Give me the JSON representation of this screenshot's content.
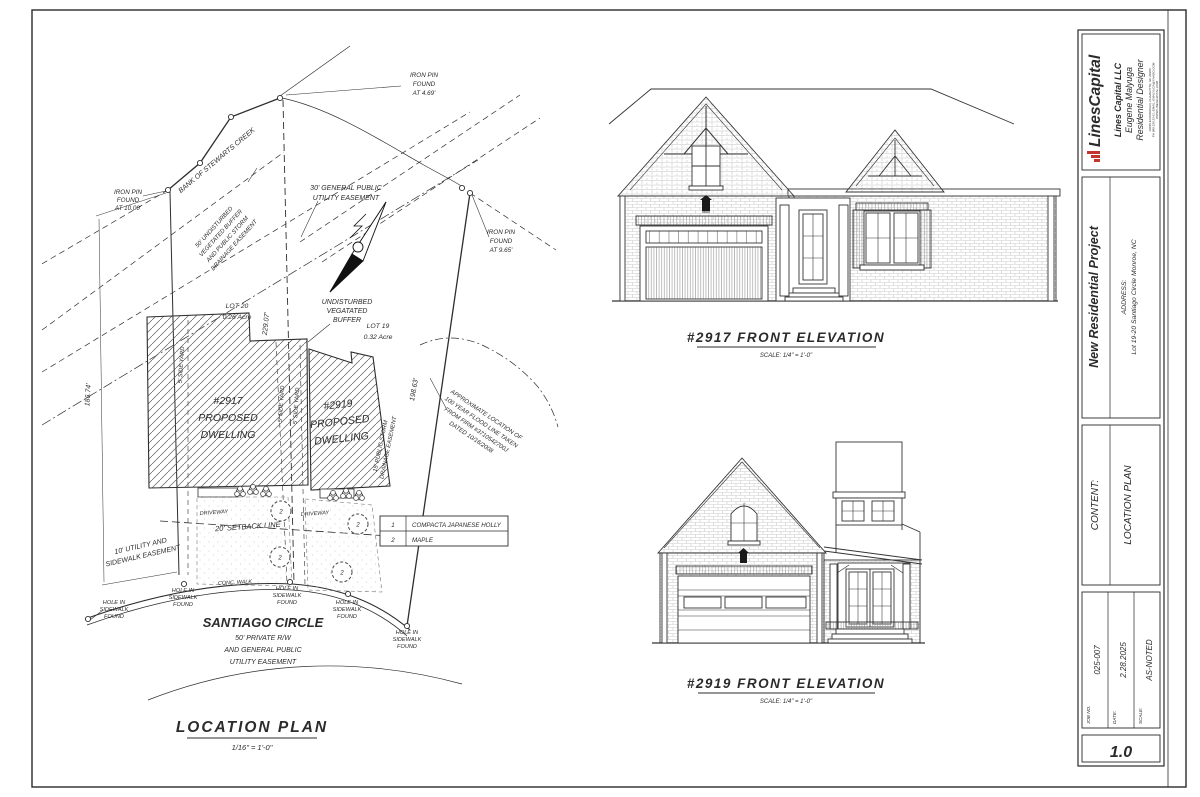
{
  "tb": {
    "logo": "LinesCapital",
    "accent": "#c23430",
    "company": "Lines Capital LLC",
    "designer": "Eugene Malyuga",
    "role": "Residential Designer",
    "contact": [
      "19035 ELDONWALN, CHARLOTTE, NC 28269",
      "PH 980 239 23 61, EMAIL: EMALYUGA@YAHOO.COM",
      "WWW.LINESCAPITAL.COM"
    ],
    "project": "New Residential Project",
    "address_label": "ADDRESS:",
    "address": "Lot 19-20 Santiago Circle Monroe, NC",
    "content_label": "CONTENT:",
    "content": "LOCATION PLAN",
    "job_label": "JOB NO.",
    "job": "025-007",
    "date_label": "DATE:",
    "date": "2.28.2025",
    "scale_label": "SCALE:",
    "scale": "AS-NOTED",
    "sheet_no": "1.0"
  },
  "plan": {
    "title": "LOCATION PLAN",
    "title_scale": "1/16\" = 1'-0\"",
    "bank": "BANK OF STEWARTS CREEK",
    "iron_pin": [
      "IRON PIN",
      "FOUND"
    ],
    "pin_10": "AT 10.00'",
    "pin_469": "AT 4.69'",
    "pin_965": "AT 9.65'",
    "easement30": [
      "30' GENERAL PUBLIC",
      "UTILITY EASEMENT"
    ],
    "buffer50": [
      "50' UNDISTURBED",
      "VEGETATED BUFFER",
      "AND PUBLIC STORM",
      "DRAINAGE EASEMENT"
    ],
    "undisturbed": [
      "UNDISTURBED",
      "VEGATATED",
      "BUFFER"
    ],
    "lot20": [
      "LOT 20",
      "0.26 Acre"
    ],
    "lot19": [
      "LOT 19",
      "0.32 Acre"
    ],
    "dim_left": "186.74'",
    "dim_mid": "229.07'",
    "dim_right": "198.63'",
    "side_yard": "5' SIDE YARD",
    "d2917": [
      "#2917",
      "PROPOSED",
      "DWELLING"
    ],
    "d2919": [
      "#2919",
      "PROPOSED",
      "DWELLING"
    ],
    "storm15": [
      "15' PUBLIC STORM",
      "DRAINAGE EASEMENT"
    ],
    "flood": [
      "APPROXIMATE LOCATION OF",
      "100 YEAR FLOOD LINE TAKEN",
      "FROM FIRM #3710542700J",
      "DATED 10/16/2008"
    ],
    "setback": "20' SETBACK LINE",
    "utility10": [
      "10' UTILITY AND",
      "SIDEWALK EASEMENT"
    ],
    "driveway": "DRIVEWAY",
    "conc_walk": "CONC. WALK",
    "hole": [
      "HOLE IN",
      "SIDEWALK",
      "FOUND"
    ],
    "road_name": "SANTIAGO CIRCLE",
    "road_sub": [
      "50' PRIVATE R/W",
      "AND GENERAL PUBLIC",
      "UTILITY EASEMENT"
    ],
    "legend": {
      "r1_num": "1",
      "r1_name": "COMPACTA JAPANESE HOLLY",
      "r2_num": "2",
      "r2_name": "MAPLE"
    },
    "maple_num": "2"
  },
  "elev": {
    "e2917": {
      "title": "#2917 FRONT ELEVATION",
      "scale": "SCALE: 1/4\" = 1'-0\""
    },
    "e2919": {
      "title": "#2919 FRONT ELEVATION",
      "scale": "SCALE: 1/4\" = 1'-0\""
    }
  }
}
